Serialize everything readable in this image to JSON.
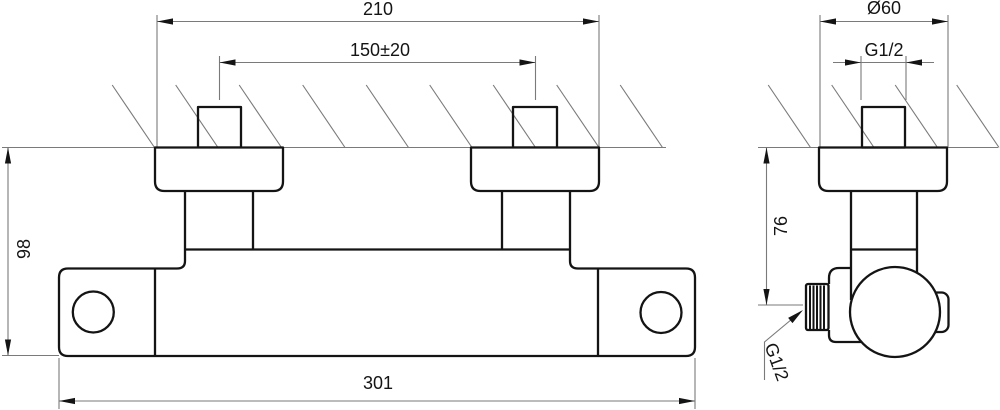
{
  "drawing": {
    "description": "Dimensioned technical drawing of a wall-mounted shower mixer, front view and side view",
    "colors": {
      "object_line": "#141414",
      "thin_line": "#7a7a7a",
      "background": "#ffffff"
    },
    "front_view": {
      "dimensions": {
        "overall_width": "210",
        "inlet_spacing": "150±20",
        "body_length": "301",
        "body_height": "98"
      }
    },
    "side_view": {
      "dimensions": {
        "escutcheon_diameter": "Ø60",
        "inlet_thread": "G1/2",
        "outlet_drop": "76",
        "outlet_thread": "G1/2"
      }
    }
  }
}
